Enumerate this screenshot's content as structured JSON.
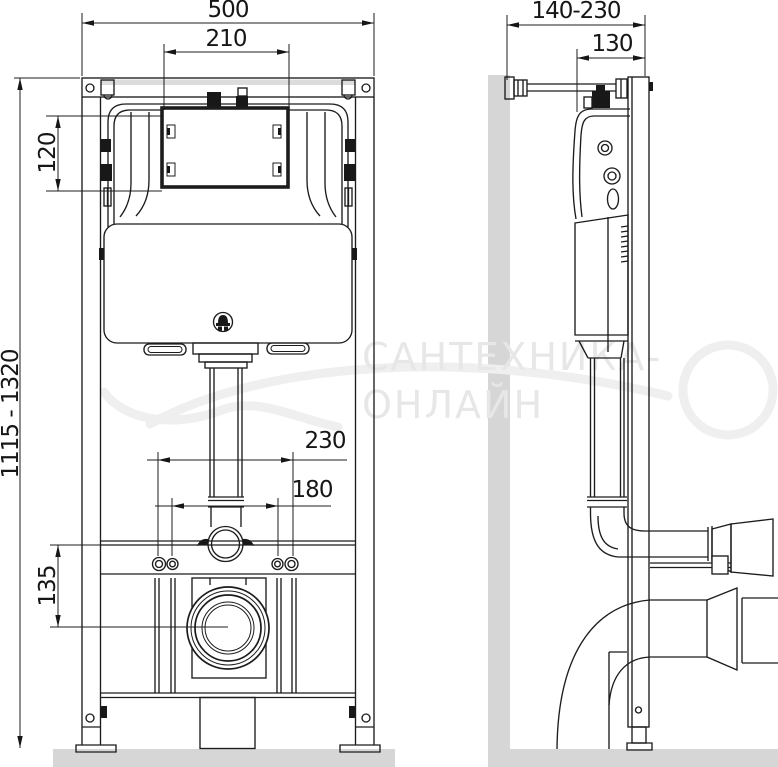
{
  "drawing": {
    "watermark": {
      "line1": "САНТЕХНИКА-",
      "line2": "ОНЛАЙН"
    },
    "dimensions": {
      "overall_width": "500",
      "access_window_width": "210",
      "access_window_height": "120",
      "installation_height_range": "1115 - 1320",
      "fixing_studs_outer_spacing": "230",
      "fixing_studs_inner_spacing": "180",
      "waste_outlet_height": "135",
      "wall_distance_range": "140-230",
      "frame_depth": "130"
    },
    "colors": {
      "line": "#1c1c1c",
      "surface_gray": "#d6d6d6",
      "watermark_gray": "#e7e7e7"
    }
  }
}
